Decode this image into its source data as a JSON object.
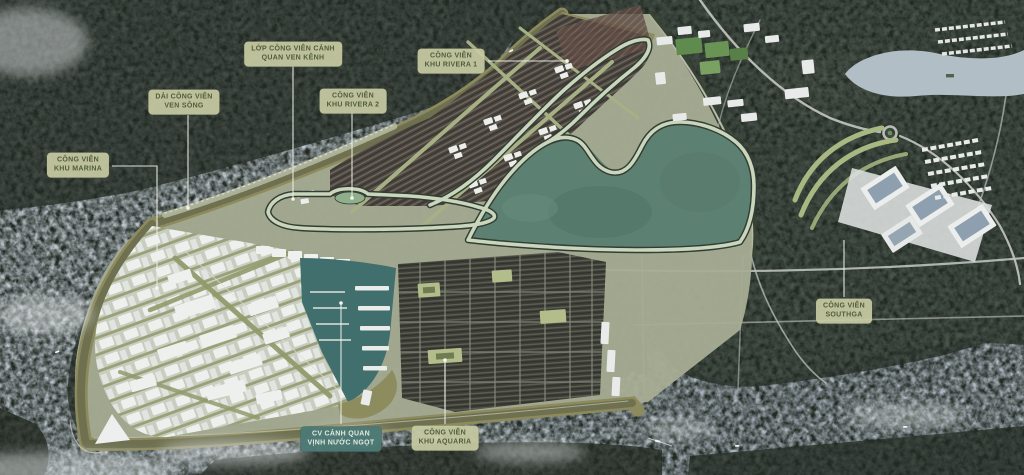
{
  "map": {
    "type": "masterplan-aerial-render",
    "labels": [
      {
        "id": "canal-park",
        "variant": "khaki",
        "lines": [
          "LỚP CÔNG VIÊN CẢNH",
          "QUAN VEN KÊNH"
        ]
      },
      {
        "id": "riverside-park",
        "variant": "khaki",
        "lines": [
          "DẢI CÔNG VIÊN",
          "VEN SÔNG"
        ]
      },
      {
        "id": "marina-park",
        "variant": "khaki",
        "lines": [
          "CÔNG VIÊN",
          "KHU MARINA"
        ]
      },
      {
        "id": "rivera-2-park",
        "variant": "khaki",
        "lines": [
          "CÔNG VIÊN",
          "KHU RIVERA 2"
        ]
      },
      {
        "id": "rivera-1-park",
        "variant": "khaki",
        "lines": [
          "CÔNG VIÊN",
          "KHU RIVERA 1"
        ]
      },
      {
        "id": "southgate-park",
        "variant": "khaki",
        "lines": [
          "CÔNG VIÊN",
          "SOUTHGA"
        ]
      },
      {
        "id": "freshwater-bay-landscape-park",
        "variant": "teal",
        "lines": [
          "CV CẢNH QUAN",
          "VỊNH NƯỚC NGỌT"
        ]
      },
      {
        "id": "aquaria-park",
        "variant": "khaki",
        "lines": [
          "CÔNG VIÊN",
          "KHU AQUARIA"
        ]
      }
    ],
    "colors": {
      "label_khaki_bg": "#c7caa3",
      "label_khaki_text": "#505c3a",
      "label_teal_bg": "#4c7975",
      "label_teal_text": "#e3eae1",
      "water": "#b5c0c8",
      "forest": "#47504a",
      "park_green": "#5c8172",
      "site_band_olive": "#8d8b5e",
      "marina_basin": "#416f6d",
      "canal_track": "#c9d6bb"
    }
  }
}
